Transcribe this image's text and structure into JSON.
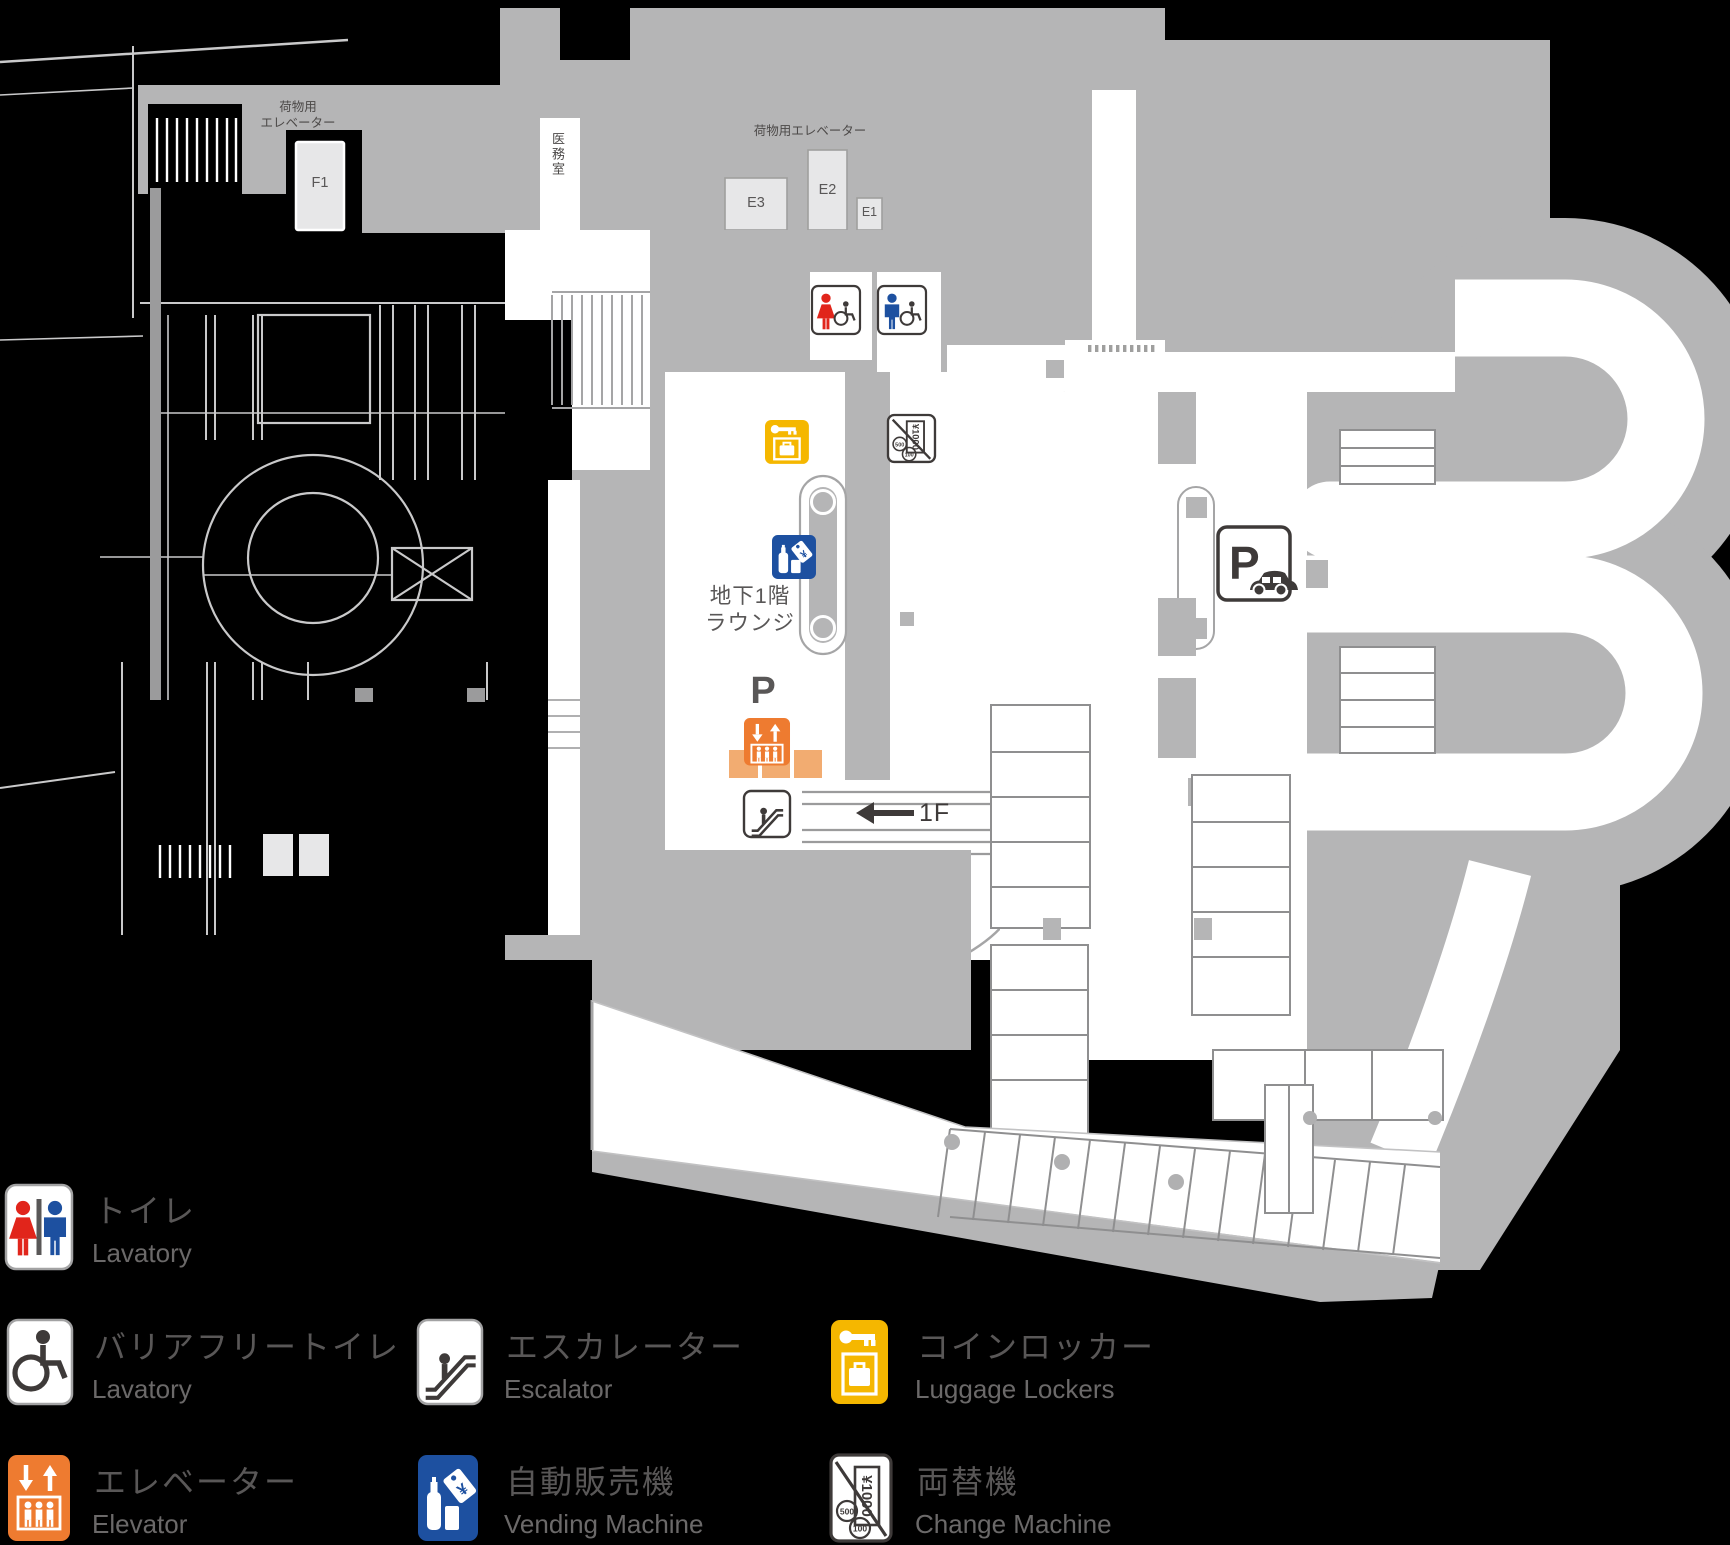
{
  "map": {
    "labels": {
      "luggage_elevator_line1": "荷物用",
      "luggage_elevator_line2": "エレベーター",
      "luggage_elevator_top": "荷物用エレベーター",
      "freight_f1": "F1",
      "freight_e1": "E1",
      "freight_e2": "E2",
      "freight_e3": "E3",
      "medical_room": "医務室",
      "lounge_line1": "地下1階",
      "lounge_line2": "ラウンジ",
      "parking_label": "P",
      "to_first_floor": "1F"
    },
    "icon_text": {
      "parking_p": "P",
      "yen": "¥",
      "bill": "¥1000",
      "coin_500": "500",
      "coin_100": "100"
    }
  },
  "legend": {
    "items": [
      {
        "id": "toilet",
        "jp": "トイレ",
        "en": "Lavatory"
      },
      {
        "id": "barrier_free_toilet",
        "jp": "バリアフリートイレ",
        "en": "Lavatory"
      },
      {
        "id": "elevator",
        "jp": "エレベーター",
        "en": "Elevator"
      },
      {
        "id": "escalator",
        "jp": "エスカレーター",
        "en": "Escalator"
      },
      {
        "id": "vending_machine",
        "jp": "自動販売機",
        "en": "Vending Machine"
      },
      {
        "id": "coin_locker",
        "jp": "コインロッカー",
        "en": "Luggage Lockers"
      },
      {
        "id": "change_machine",
        "jp": "両替機",
        "en": "Change Machine"
      }
    ]
  },
  "colors": {
    "background": "#000000",
    "floor_gray": "#b5b5b6",
    "room_white": "#ffffff",
    "box_gray": "#e7e7e8",
    "outline_gray": "#9f9f9e",
    "icon_dark": "#3e3a39",
    "text_gray": "#595757",
    "toilet_red": "#e1251b",
    "toilet_blue": "#1d50a0",
    "elevator_orange": "#ee7b30",
    "elevator_orange_light": "#f2ac71",
    "locker_yellow": "#f5b700",
    "vending_blue": "#1d50a0"
  }
}
